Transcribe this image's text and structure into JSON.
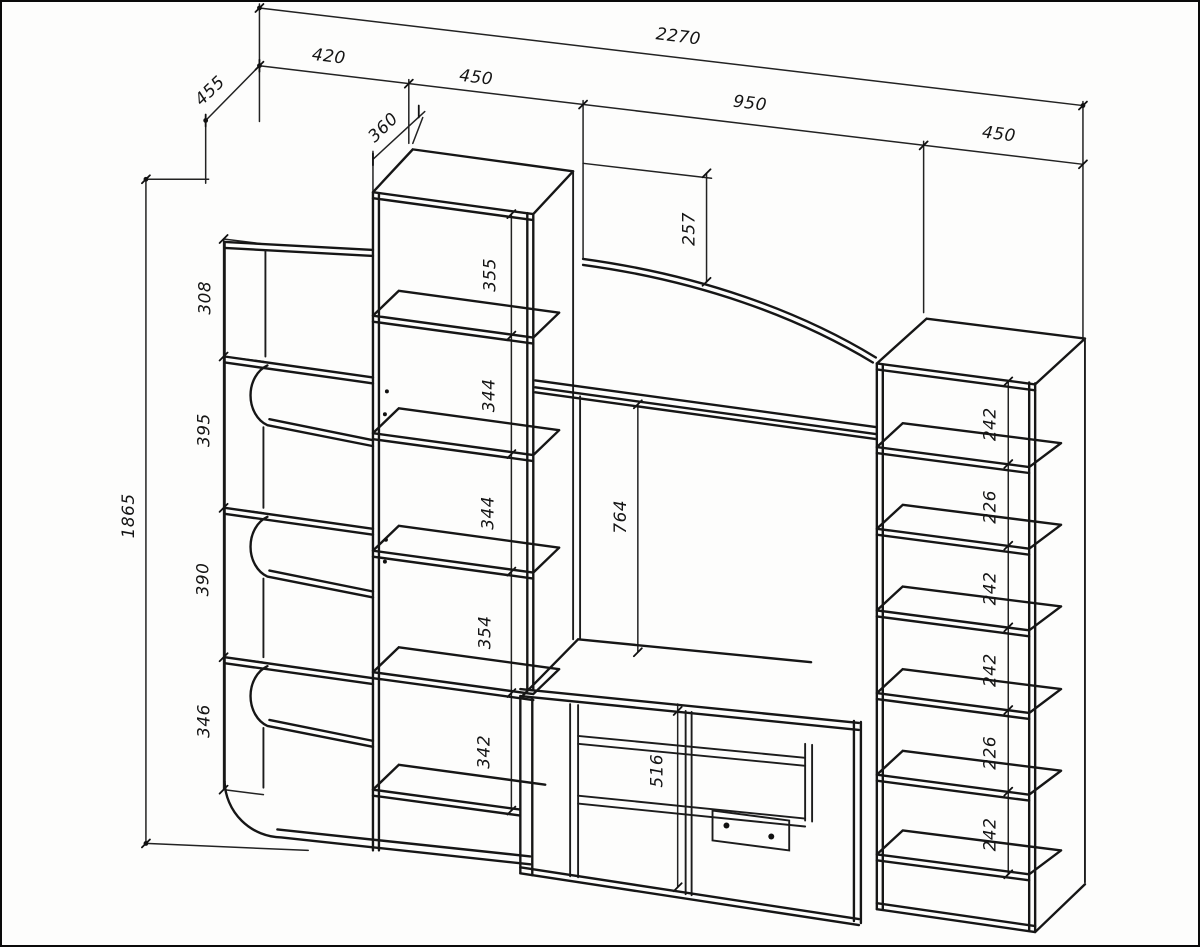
{
  "drawing": {
    "type": "furniture wall-unit technical drawing",
    "units": "mm",
    "dims": {
      "overall_width": "2270",
      "overall_height": "1865",
      "side_depth": "455",
      "column_depth": "360",
      "arch_height": "257",
      "niche_height": "764",
      "stand_height": "516",
      "top": [
        "420",
        "450",
        "950",
        "450"
      ],
      "left": [
        "308",
        "395",
        "390",
        "346"
      ],
      "middle": [
        "355",
        "344",
        "344",
        "354",
        "342"
      ],
      "right": [
        "242",
        "226",
        "242",
        "242",
        "226",
        "242"
      ]
    }
  }
}
